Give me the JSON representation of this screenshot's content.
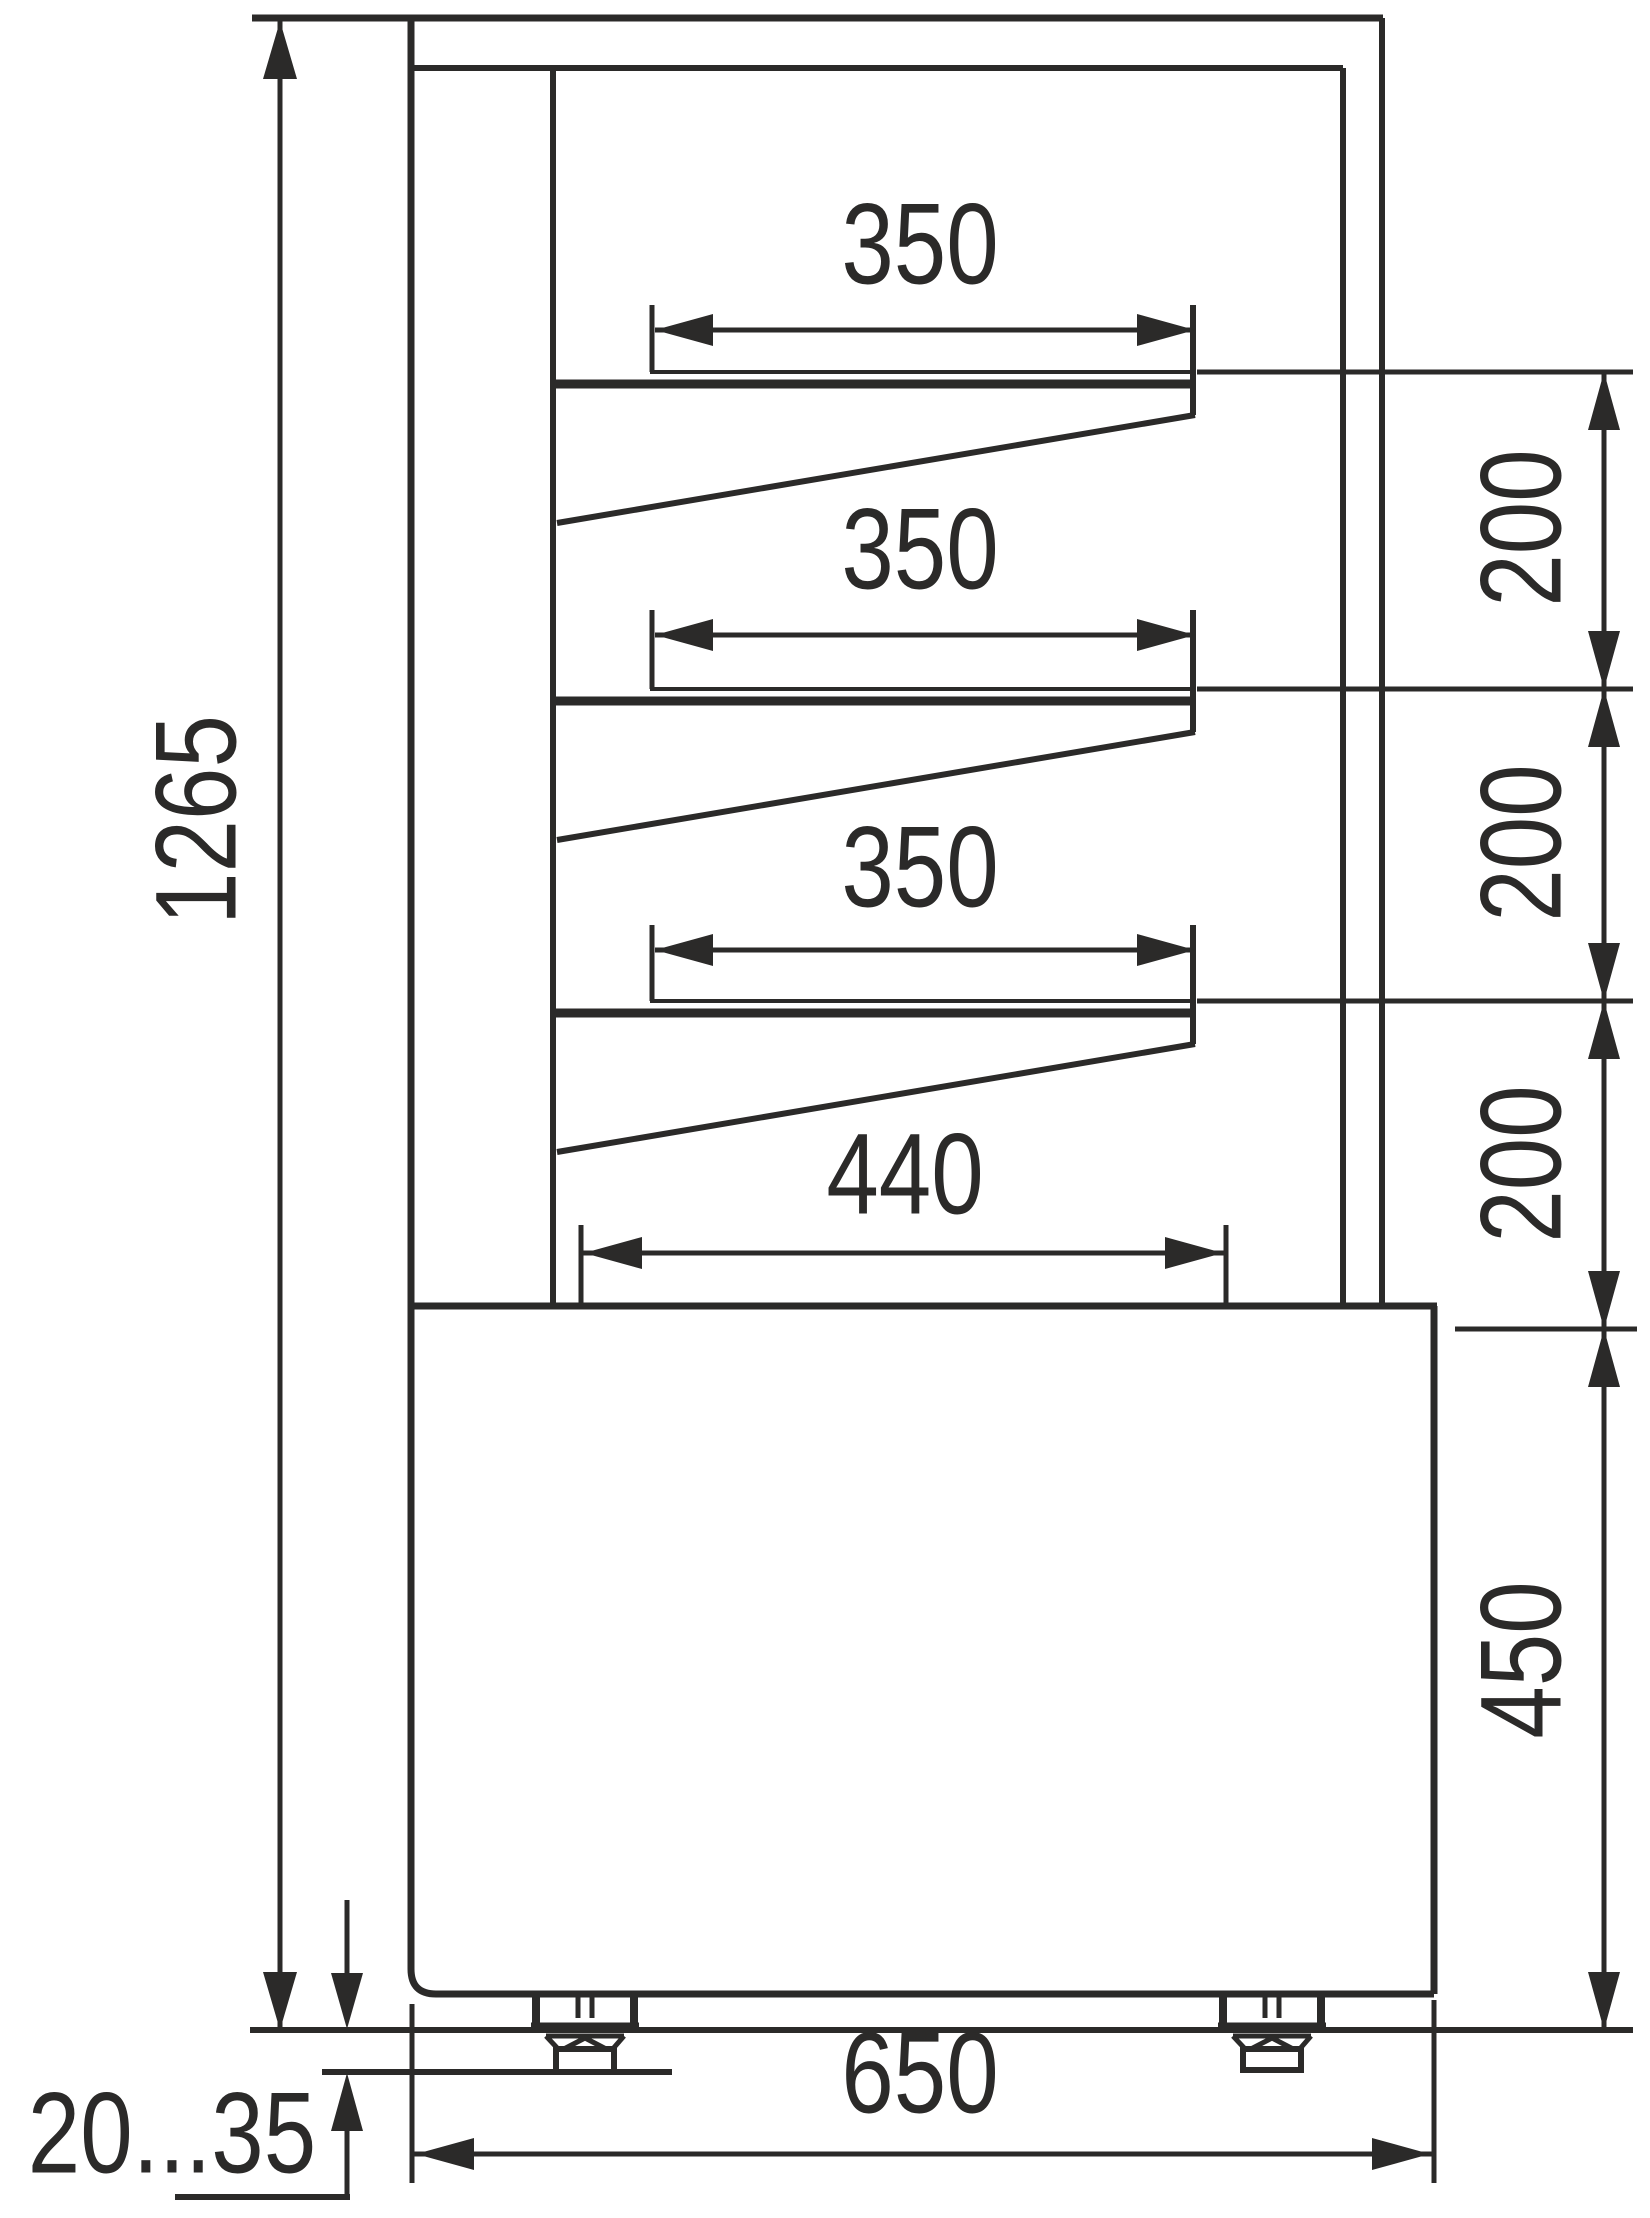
{
  "drawing": {
    "kind": "refrigerated display case side-view dimension drawing",
    "units": "mm",
    "line_color": "#2b2a29",
    "background_color": "#ffffff",
    "labels": {
      "overall_height": "1265",
      "shelf_depth_top": "350",
      "shelf_depth_middle": "350",
      "shelf_depth_lower": "350",
      "deck_depth": "440",
      "spacing_top": "200",
      "spacing_middle": "200",
      "spacing_lower": "200",
      "base_height": "450",
      "overall_depth": "650",
      "leg_adjustment": "20...35"
    }
  }
}
